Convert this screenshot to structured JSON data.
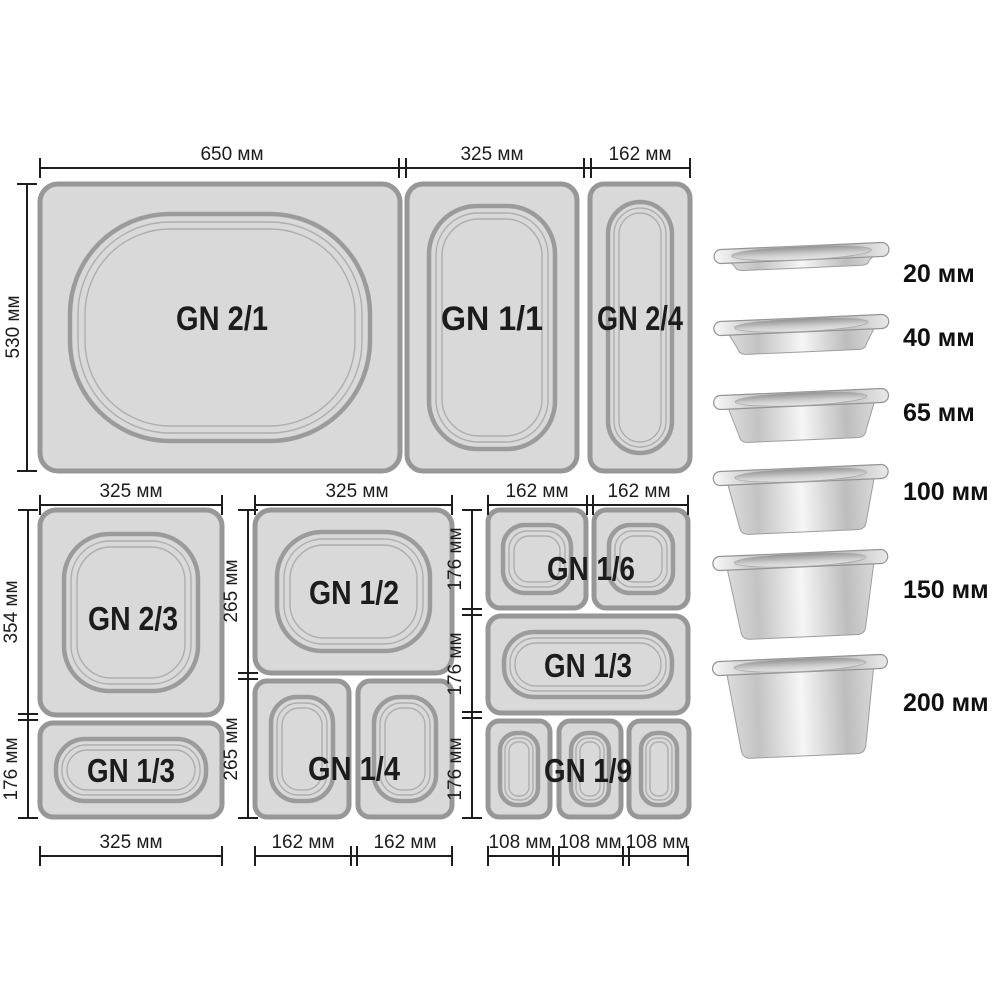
{
  "pans": {
    "gn21": {
      "label": "GN 2/1"
    },
    "gn11": {
      "label": "GN 1/1"
    },
    "gn24": {
      "label": "GN 2/4"
    },
    "gn23": {
      "label": "GN 2/3"
    },
    "gn13_left": {
      "label": "GN 1/3"
    },
    "gn12": {
      "label": "GN 1/2"
    },
    "gn14": {
      "label": "GN 1/4"
    },
    "gn16": {
      "label": "GN 1/6"
    },
    "gn13_right": {
      "label": "GN 1/3"
    },
    "gn19": {
      "label": "GN 1/9"
    }
  },
  "dims": {
    "top_row": {
      "w1": "650 мм",
      "w2": "325 мм",
      "w3": "162 мм",
      "h": "530 мм"
    },
    "left_col": {
      "top": "325 мм",
      "h1": "354 мм",
      "h2": "176 мм",
      "bottom": "325 мм"
    },
    "mid_col": {
      "top": "325 мм",
      "h1": "265 мм",
      "h2": "265 мм",
      "b1": "162 мм",
      "b2": "162 мм"
    },
    "right_col": {
      "t1": "162 мм",
      "t2": "162 мм",
      "h1": "176 мм",
      "h2": "176 мм",
      "h3": "176 мм",
      "b1": "108 мм",
      "b2": "108 мм",
      "b3": "108 мм"
    }
  },
  "depth_column": {
    "items": [
      {
        "label": "20 мм"
      },
      {
        "label": "40 мм"
      },
      {
        "label": "65 мм"
      },
      {
        "label": "100 мм"
      },
      {
        "label": "150 мм"
      },
      {
        "label": "200 мм"
      }
    ]
  },
  "colors": {
    "pan_fill": "#d9d9d9",
    "pan_border": "#979797",
    "dim_line": "#1d1d1d",
    "label_text": "#1c1c1c"
  }
}
